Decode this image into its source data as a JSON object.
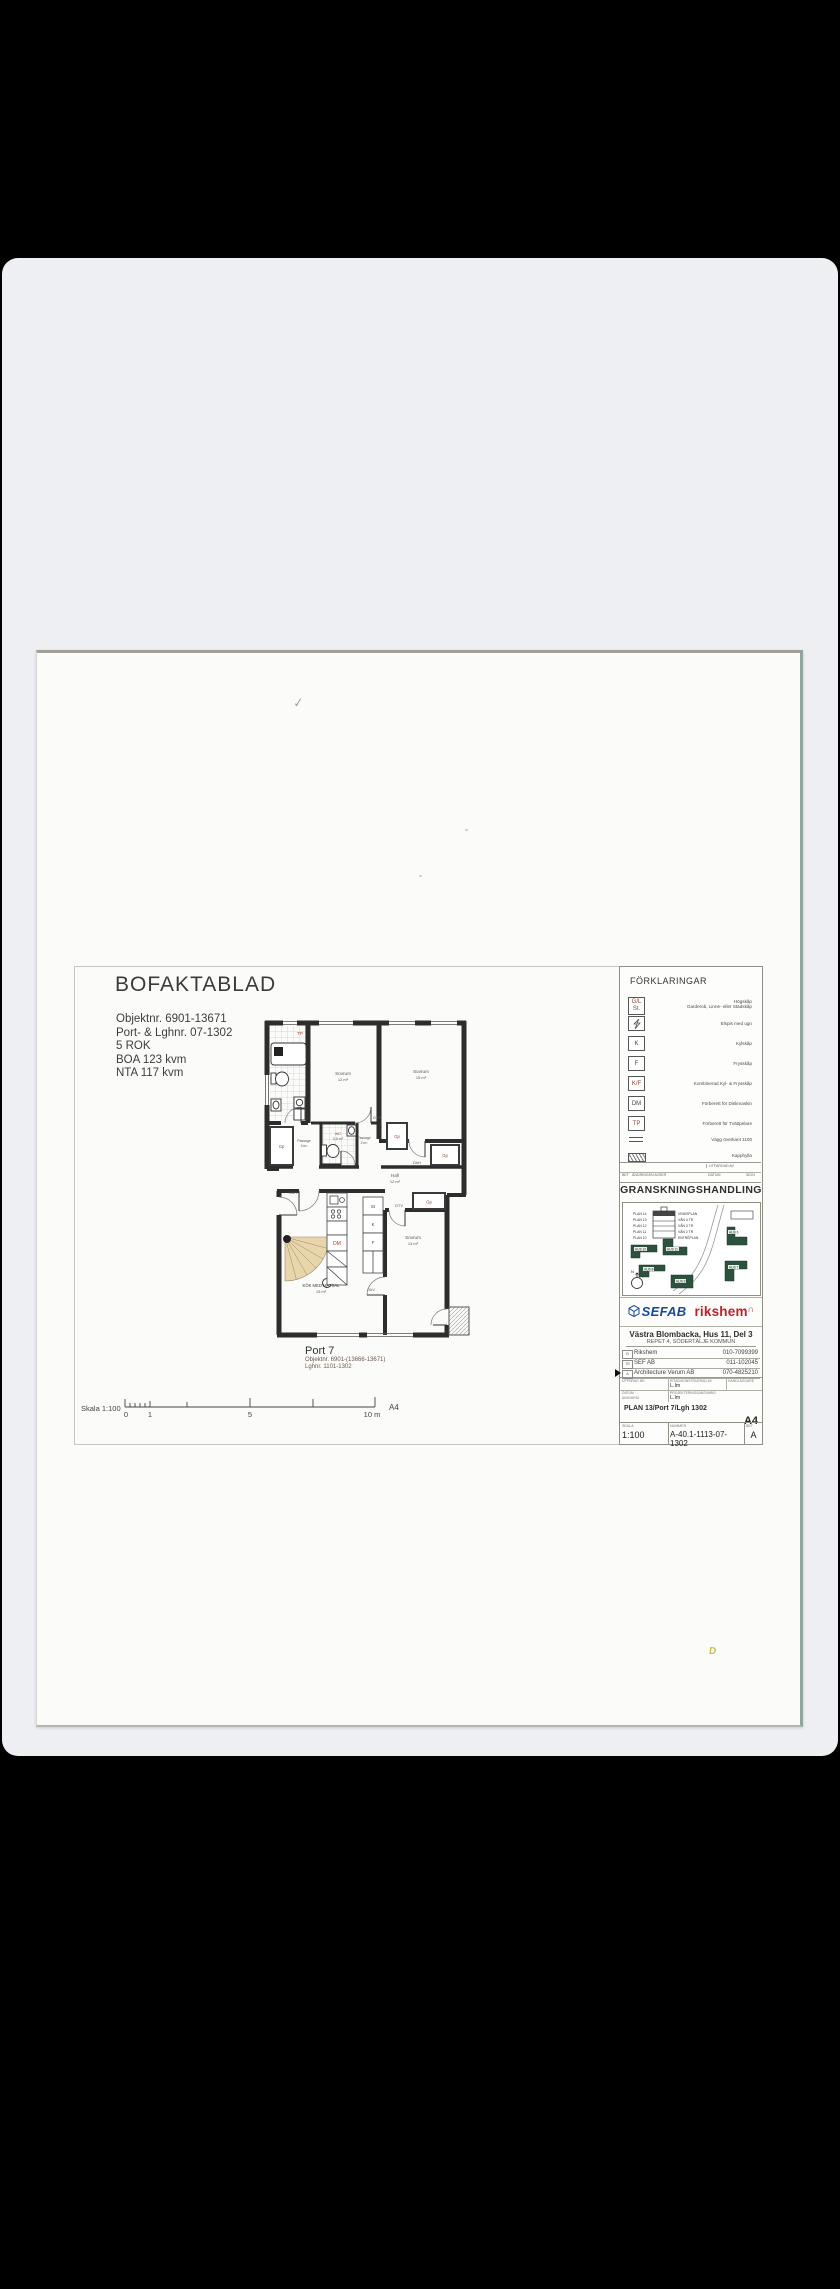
{
  "artifacts": {
    "checkmark": "✓",
    "stain": "D"
  },
  "document": {
    "title": "BOFAKTABLAD",
    "info": [
      "Objektnr. 6901-13671",
      "Port- & Lghnr. 07-1302",
      "5 ROK",
      "BOA 123 kvm",
      "NTA 117 kvm"
    ],
    "port": {
      "title": "Port 7",
      "line1": "Objektnr. 6901-(13666-13671)",
      "line2": "Lghnr. 1101-1302"
    },
    "scalebar": {
      "label": "Skala 1:100",
      "t0": "0",
      "t1": "1",
      "t5": "5",
      "t10": "10 m",
      "format": "A4"
    }
  },
  "plan": {
    "rooms": {
      "sovrum1": {
        "name": "Sovrum",
        "area": "12 m²"
      },
      "sovrum2": {
        "name": "Sovrum",
        "area": "15 m²"
      },
      "sovrum3": {
        "name": "Sovrum",
        "area": "14 m²"
      },
      "hall": {
        "name": "Hall",
        "area": "12 m²"
      },
      "wc": {
        "name": "WC",
        "area": "3,5 m²"
      },
      "kok": {
        "name": "KÖK MED MATSAL",
        "area": "15 m²"
      },
      "passage1": {
        "name": "Passage",
        "area": "3 m²"
      },
      "passage2": {
        "name": "Passage",
        "area": "2 m²"
      }
    },
    "tags": {
      "tp": "TP",
      "dm": "DM",
      "gp": "Gp",
      "st": "St",
      "k": "K",
      "f": "F",
      "dkh": "DkH",
      "dtv": "DTV",
      "dkv": "DkV"
    }
  },
  "legend": {
    "header": "FÖRKLARINGAR",
    "items": [
      {
        "sym1": "G/L",
        "sym2": "St.",
        "label1": "Högskåp",
        "label2": "Garderob, Linne- eller Städskåp"
      },
      {
        "label": "Elspis med ugn"
      },
      {
        "sym": "K",
        "label": "Kylskåp"
      },
      {
        "sym": "F",
        "label": "Frysskåp"
      },
      {
        "sym": "K/F",
        "label": "Kombinerad Kyl- & Frysskåp"
      },
      {
        "sym": "DM",
        "label": "Förberett för Diskmaskin"
      },
      {
        "sym": "TP",
        "label": "Förberett för Tvättpelare"
      },
      {
        "label": "Vägg överkant 1100"
      },
      {
        "label": "Kapphylla"
      }
    ]
  },
  "revision": {
    "utfardad": "UTFÄRDAD AV",
    "bet": "BET",
    "andringen": "ÄNDRINGEN AVSER",
    "datum": "DATUM",
    "sign": "SIGN"
  },
  "stamp": {
    "granskning": "GRANSKNINGSHANDLING",
    "plans": [
      {
        "plan": "PLAN 14",
        "desc": "VINDSPLAN"
      },
      {
        "plan": "PLAN 13",
        "desc": "VÅN 4 TR"
      },
      {
        "plan": "PLAN 12",
        "desc": "VÅN 3 TR"
      },
      {
        "plan": "PLAN 11",
        "desc": "VÅN 2 TR"
      },
      {
        "plan": "PLAN 10",
        "desc": "ENTRÉPLAN"
      }
    ],
    "buildings": [
      "HUS 10",
      "HUS 11",
      "HUS 8",
      "HUS 9",
      "HUS 6",
      "HUS 7"
    ],
    "north": "N",
    "sefab": "SEFAB",
    "rikshem": "rikshem",
    "roof": "∩",
    "project": "Västra Blombacka, Hus 11, Del 3",
    "location": "REPET 4, SÖDERTÄLJE KOMMUN",
    "consultants": [
      {
        "code": "B",
        "name": "Rikshem",
        "phone": "010-7099399"
      },
      {
        "code": "TE",
        "name": "SEF AB",
        "phone": "011-102045"
      },
      {
        "code": "A",
        "name": "Architecture Verum AB",
        "phone": "070-4825210"
      }
    ],
    "meta": {
      "uppdrag": "UPPDRAG NR",
      "ritad": "RITAD/KONSTRUERAD AV",
      "handlaggare": "HANDLÄGGARE",
      "datum": "DATUM",
      "ansvarig": "ANSVARIG",
      "projansvarig": "PROJEKTERINGSANSVARIG",
      "ritad_value": "L.lm",
      "projansvarig_value": "L.lm"
    },
    "content_desc": "PLAN 13/Port 7/Lgh 1302",
    "format": "A4",
    "skala_label": "SKALA",
    "skala_value": "1:100",
    "nummer_label": "NUMMER",
    "nummer_value": "A-40.1-1113-07-1302",
    "bet_label": "BET",
    "bet_value": "A"
  }
}
